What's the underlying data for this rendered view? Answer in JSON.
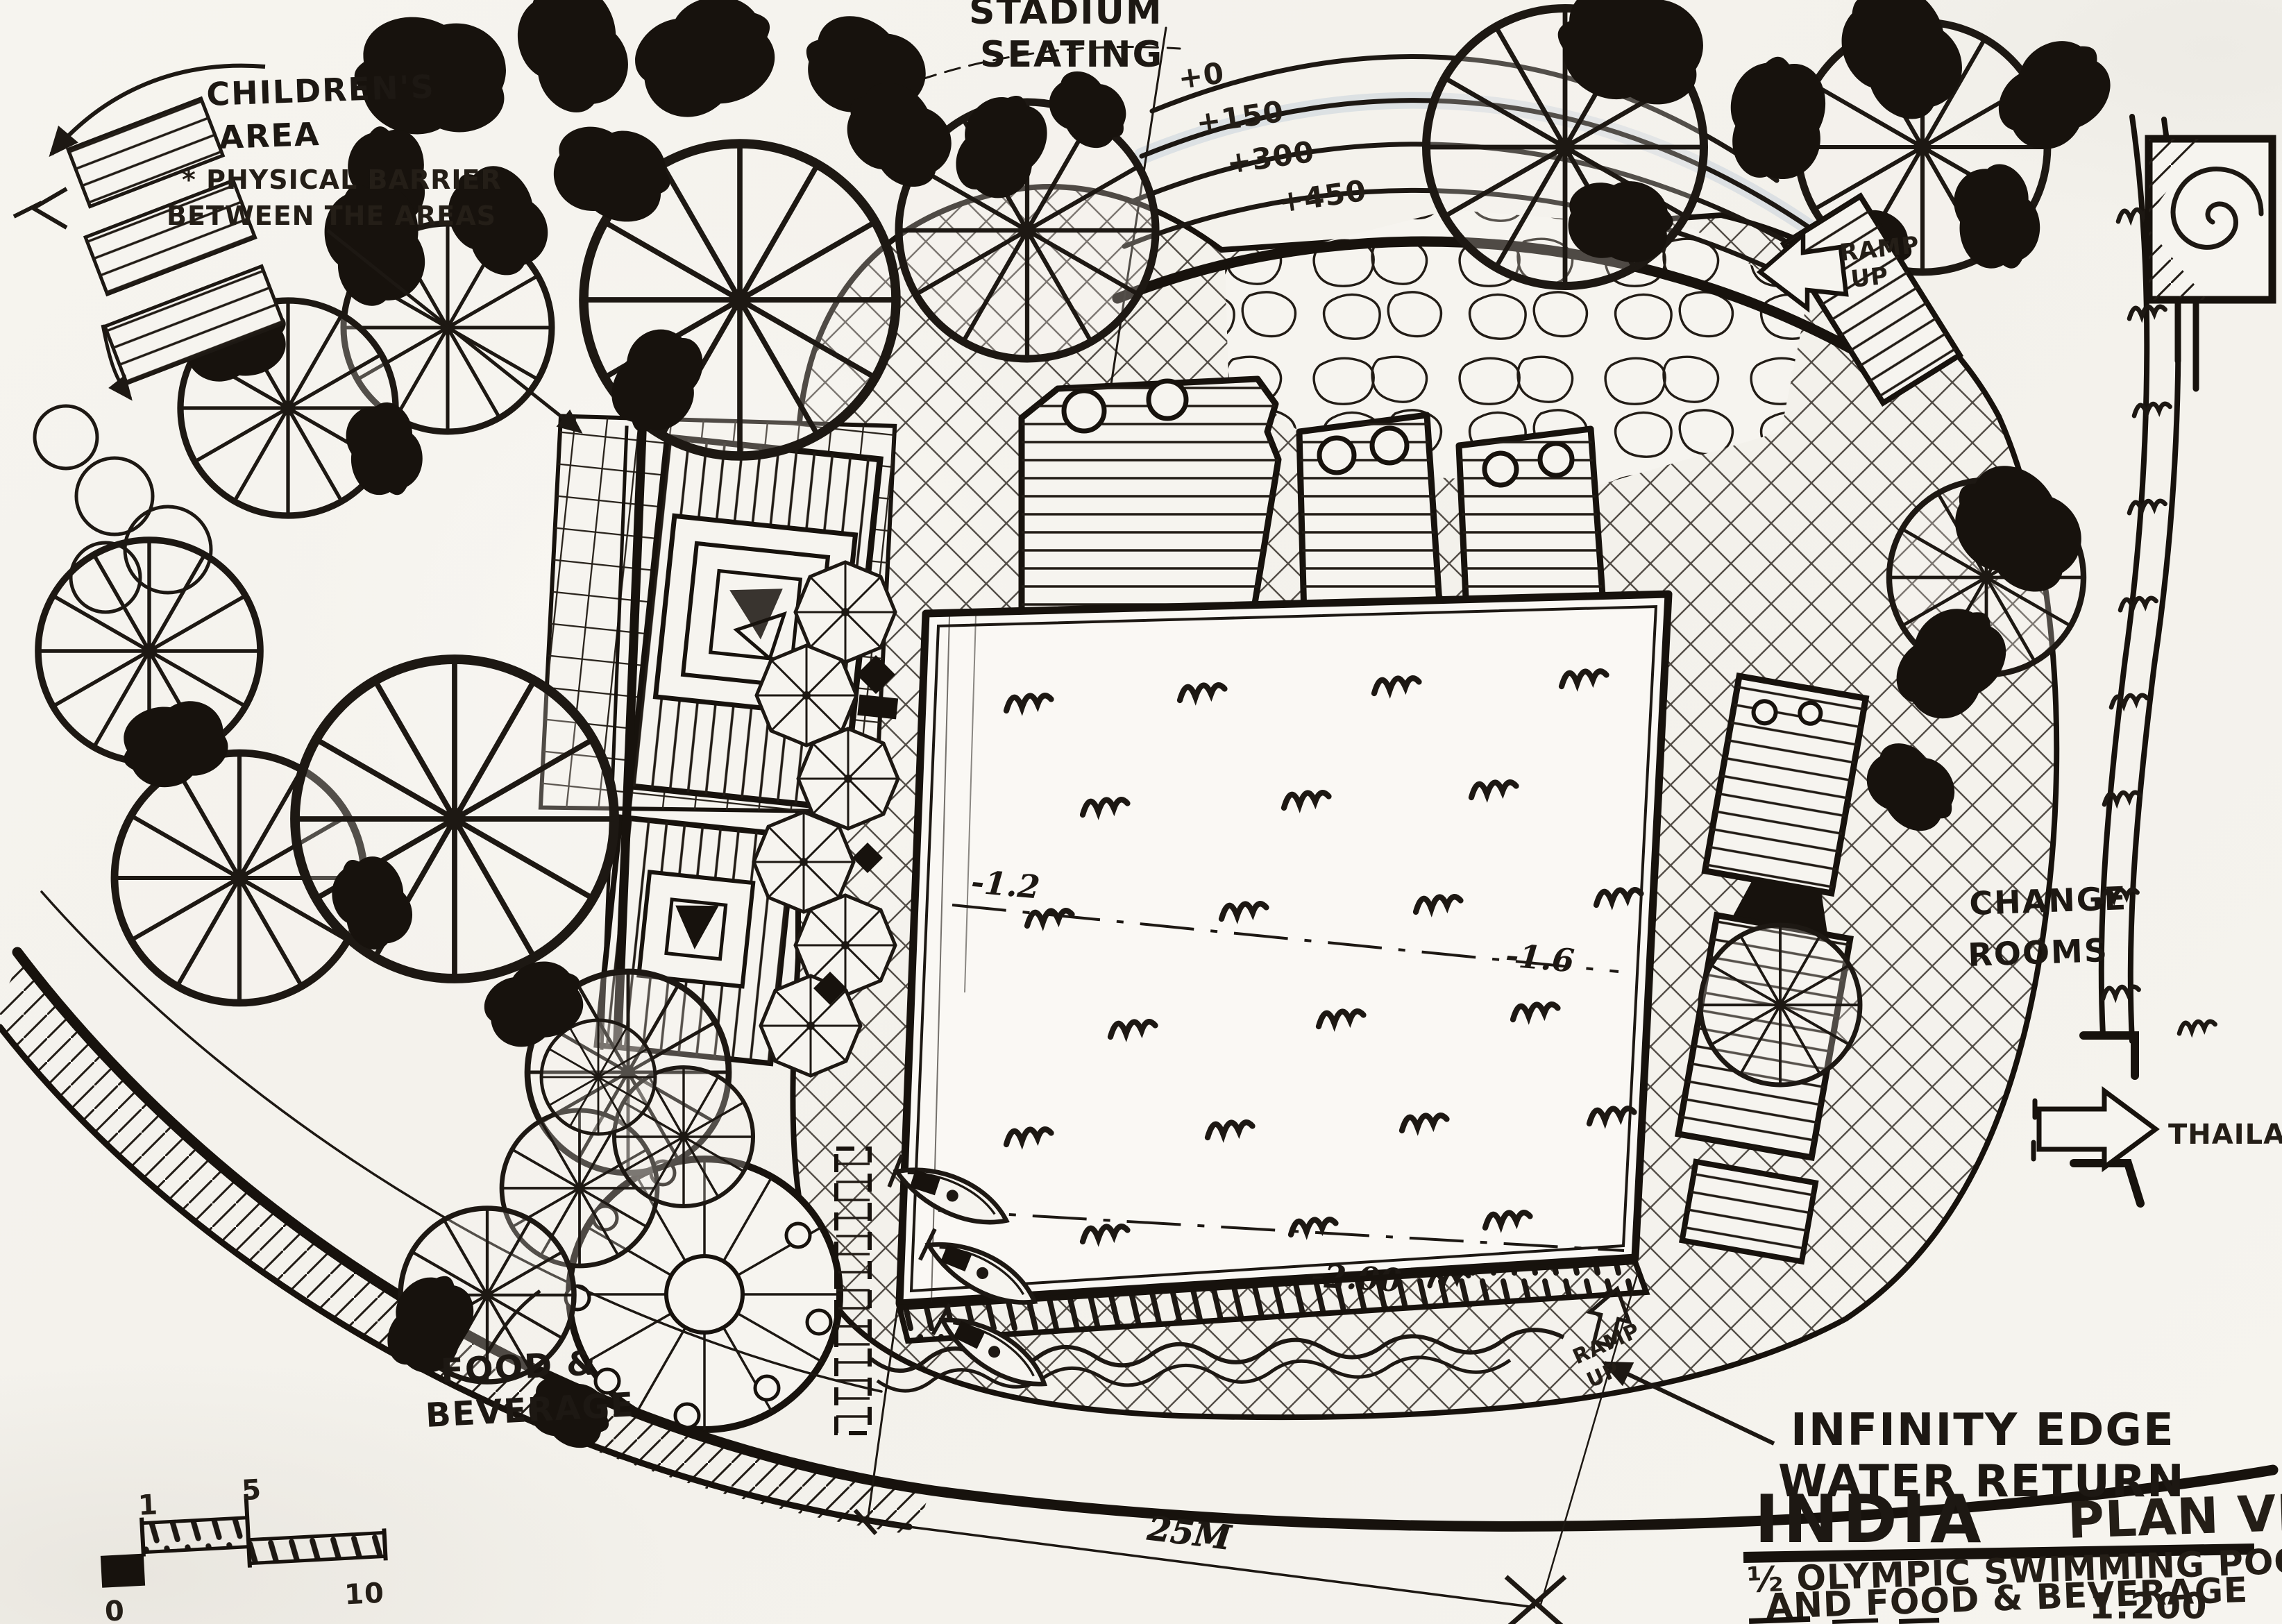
{
  "title_block": {
    "project": "INDIA",
    "view_type": "PLAN VIEW",
    "description": [
      "½ OLYMPIC SWIMMING POOL",
      "AND FOOD & BEVERAGE"
    ],
    "scale": "1:200"
  },
  "labels": {
    "stadium_seating": [
      "STADIUM",
      "SEATING"
    ],
    "childrens_area": [
      "CHILDREN'S",
      "AREA"
    ],
    "physical_barrier": [
      "* PHYSICAL BARRIER",
      "BETWEEN THE AREAS"
    ],
    "ramp_up_top": [
      "RAMP",
      "UP"
    ],
    "ramp_up_pool": [
      "RAMP",
      "UP"
    ],
    "change_rooms": [
      "CHANGE",
      "ROOMS"
    ],
    "thailand": "THAILAND",
    "food_beverage": [
      "FOOD &",
      "BEVERAGE"
    ],
    "infinity_edge": [
      "INFINITY EDGE",
      "WATER RETURN"
    ]
  },
  "seating_elevations": [
    "+0",
    "+150",
    "+300",
    "+450"
  ],
  "pool_depths": {
    "shallow": "-1.2",
    "mid": "-1.6",
    "deep": "-2.00"
  },
  "dimension_pool_length": "25M",
  "scale_bar": [
    "0",
    "1",
    "5",
    "10"
  ],
  "colors": {
    "ink": "#1d1813",
    "paper": "#f6f4ef"
  }
}
